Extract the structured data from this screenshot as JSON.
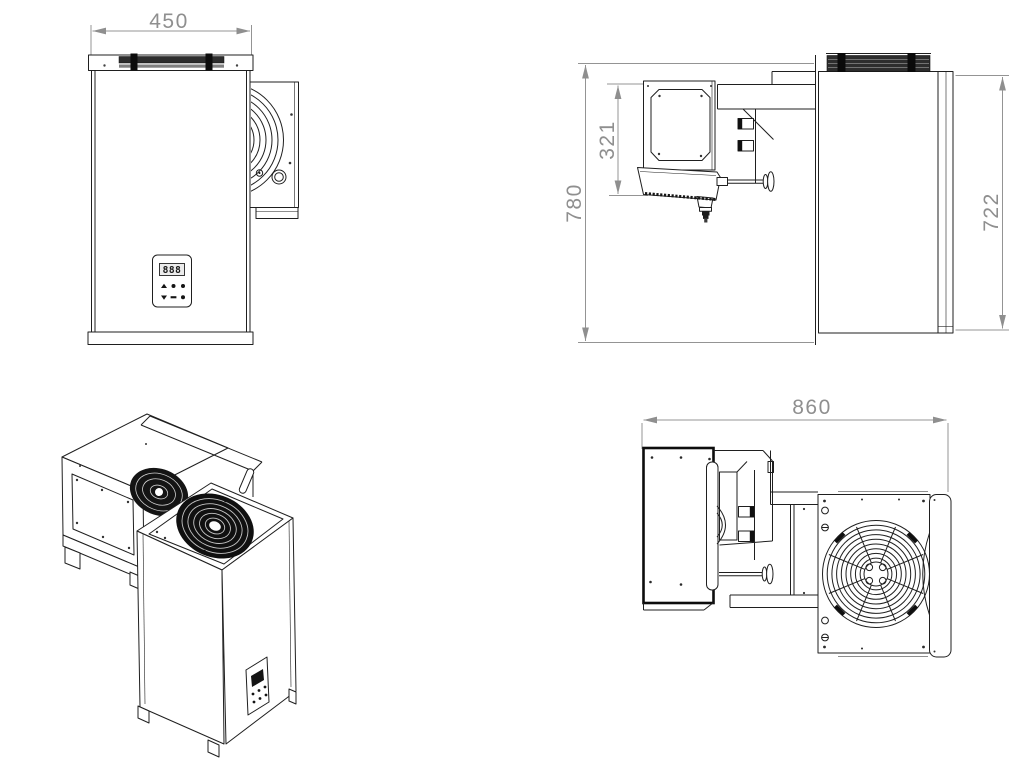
{
  "drawing_type": "monoblock-refrigeration-unit-technical-drawing",
  "colors": {
    "background": "#ffffff",
    "line": "#1f1f1f",
    "dark_fill": "#141414",
    "dimension": "#8f8f8f"
  },
  "dimensions": {
    "front_width": "450",
    "side_overall_height": "780",
    "side_evaporator_height": "321",
    "side_body_height": "722",
    "top_overall_depth": "860"
  },
  "control_panel": {
    "display_text": "888",
    "button_icons": [
      "up-arrow-icon",
      "dot-icon",
      "dot-icon",
      "down-arrow-icon",
      "dash-icon",
      "dot-icon"
    ]
  },
  "icons": {
    "fan_guard": "fan-guard-icon",
    "fan_top": "axial-fan-icon",
    "drain": "drain-spout-icon"
  }
}
